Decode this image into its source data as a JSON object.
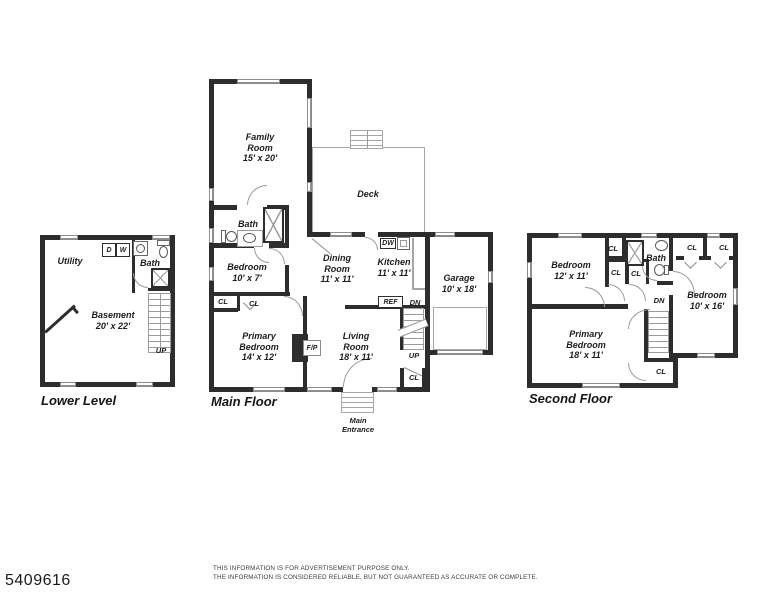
{
  "palette": {
    "wall": "#2d2d2d",
    "light_line": "#a6a6a6",
    "text": "#1c1c1c"
  },
  "footer": {
    "listing_id": "5409616",
    "disclaimer1": "THIS INFORMATION IS FOR ADVERTISEMENT PURPOSE ONLY.",
    "disclaimer2": "THE INFORMATION IS CONSIDERED RELIABLE, BUT NOT GUARANTEED AS ACCURATE OR COMPLETE."
  },
  "lower_level": {
    "title": "Lower Level",
    "rooms": {
      "utility": {
        "name": "Utility"
      },
      "bath": {
        "name": "Bath"
      },
      "basement": {
        "name": "Basement",
        "dims": "20' x 22'"
      }
    },
    "fixtures": {
      "dryer": "D",
      "washer": "W"
    },
    "stairs": {
      "up": "UP"
    }
  },
  "main_floor": {
    "title": "Main Floor",
    "rooms": {
      "family": {
        "name": "Family Room",
        "dims": "15' x 20'"
      },
      "deck": {
        "name": "Deck"
      },
      "bath": {
        "name": "Bath"
      },
      "bedroom": {
        "name": "Bedroom",
        "dims": "10' x 7'"
      },
      "primary": {
        "name": "Primary Bedroom",
        "dims": "14' x 12'"
      },
      "dining": {
        "name": "Dining Room",
        "dims": "11' x 11'"
      },
      "kitchen": {
        "name": "Kitchen",
        "dims": "11' x 11'"
      },
      "living": {
        "name": "Living Room",
        "dims": "18' x 11'"
      },
      "garage": {
        "name": "Garage",
        "dims": "10' x 18'"
      }
    },
    "fixtures": {
      "dishwasher": "DW",
      "refrigerator": "REF",
      "fireplace": "F/P"
    },
    "closets": {
      "hall_closet_1": "CL",
      "hall_closet_2": "CL",
      "entry_closet": "CL"
    },
    "stairs": {
      "down": "DN",
      "up": "UP"
    },
    "entrance": "Main Entrance"
  },
  "second_floor": {
    "title": "Second Floor",
    "rooms": {
      "bedroom_front": {
        "name": "Bedroom",
        "dims": "12' x 11'"
      },
      "bath": {
        "name": "Bath"
      },
      "bedroom_rear": {
        "name": "Bedroom",
        "dims": "10' x 16'"
      },
      "primary": {
        "name": "Primary Bedroom",
        "dims": "18' x 11'"
      }
    },
    "closets": {
      "hall_closet": "CL",
      "linen_closet_1": "CL",
      "linen_closet_2": "CL",
      "rear_closet_1": "CL",
      "rear_closet_2": "CL",
      "stair_closet": "CL"
    },
    "stairs": {
      "down": "DN"
    }
  }
}
